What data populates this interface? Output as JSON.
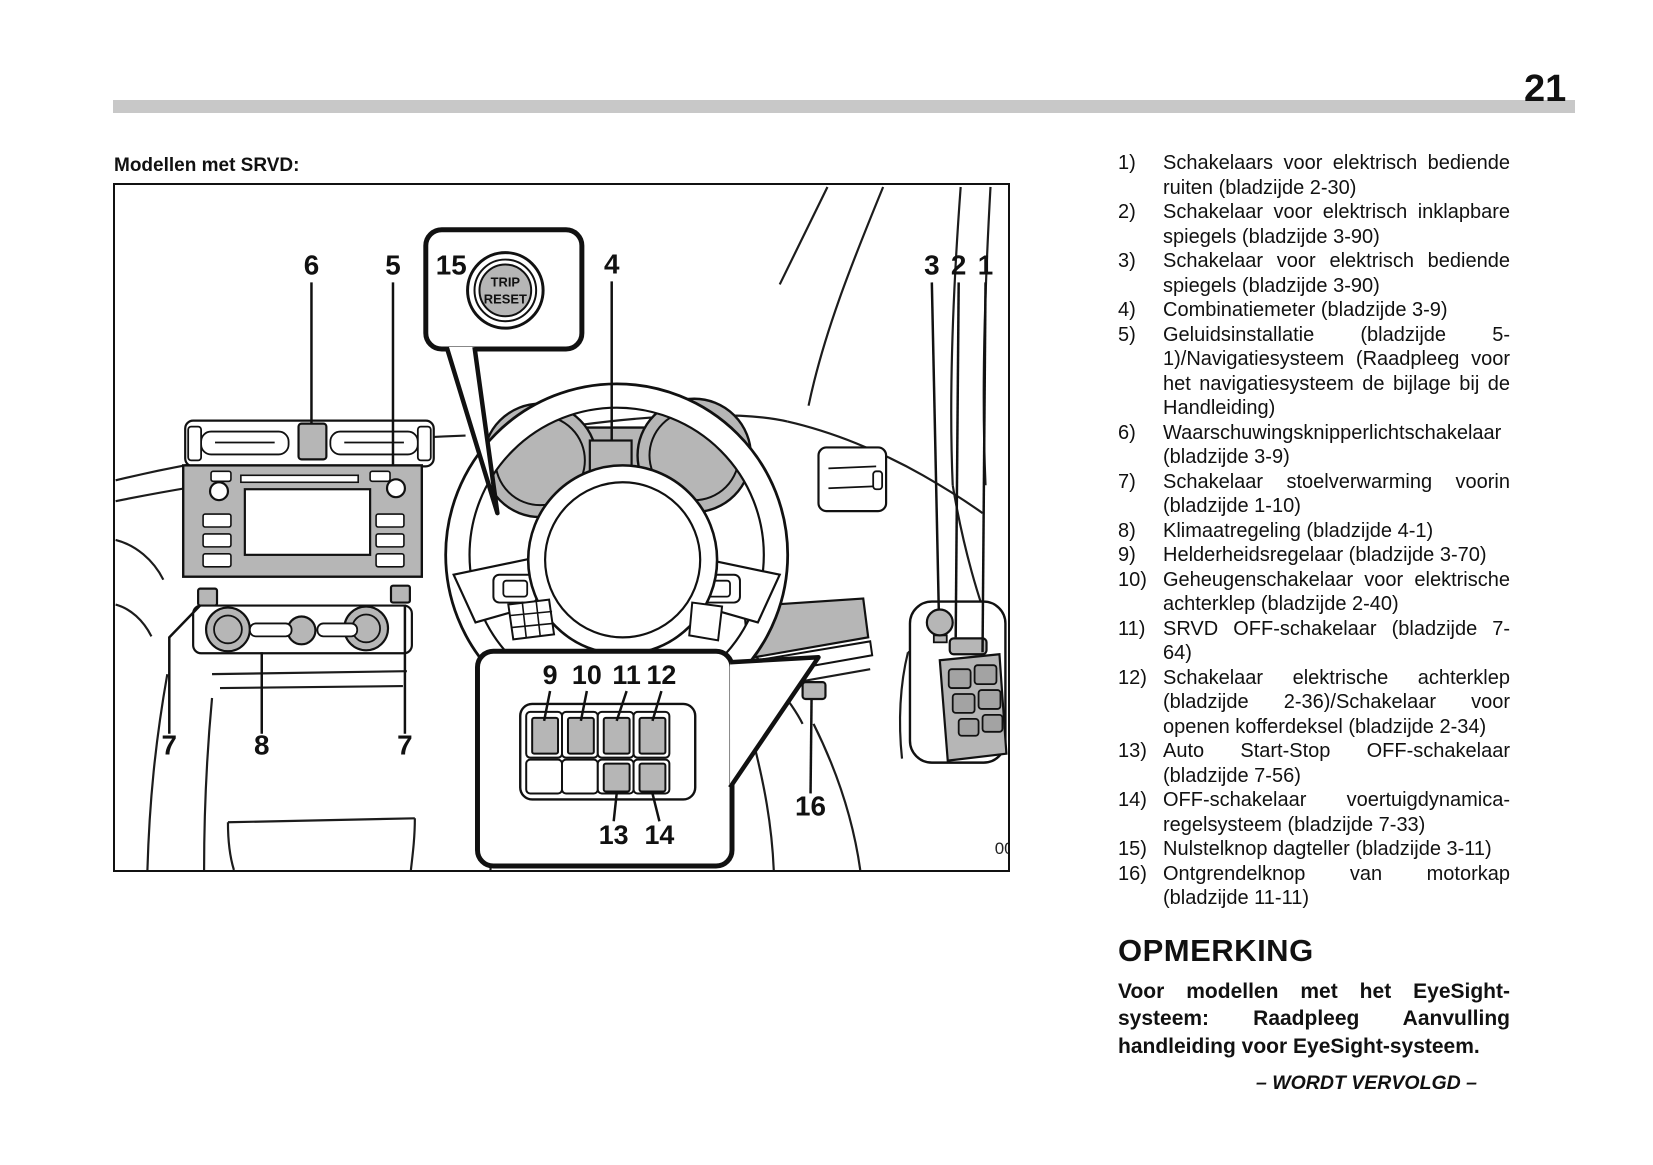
{
  "page": {
    "number": "21",
    "continued_footer": "– WORDT VERVOLGD –"
  },
  "figure": {
    "heading": "Modellen met SRVD:",
    "code": "001502",
    "trip_button": {
      "line1": "TRIP",
      "line2": "RESET"
    },
    "callouts": {
      "one": "1",
      "two": "2",
      "three": "3",
      "four": "4",
      "five": "5",
      "six": "6",
      "seven_left": "7",
      "seven_right": "7",
      "eight": "8",
      "nine": "9",
      "ten": "10",
      "eleven": "11",
      "twelve": "12",
      "thirteen": "13",
      "fourteen": "14",
      "fifteen": "15",
      "sixteen": "16"
    }
  },
  "legend": {
    "items": [
      {
        "num": "1)",
        "text": "Schakelaars voor elektrisch bediende ruiten (bladzijde 2-30)"
      },
      {
        "num": "2)",
        "text": "Schakelaar voor elektrisch inklapbare spiegels (bladzijde 3-90)"
      },
      {
        "num": "3)",
        "text": "Schakelaar voor elektrisch bediende spiegels (bladzijde 3-90)"
      },
      {
        "num": "4)",
        "text": "Combinatiemeter (bladzijde 3-9)"
      },
      {
        "num": "5)",
        "text": "Geluidsinstallatie (bladzijde 5-1)/Navigatiesysteem (Raadpleeg voor het navigatiesysteem de bijlage bij de Handleiding)"
      },
      {
        "num": "6)",
        "text": "Waarschuwingsknipperlichtschakelaar (bladzijde 3-9)"
      },
      {
        "num": "7)",
        "text": "Schakelaar stoelverwarming voorin (bladzijde 1-10)"
      },
      {
        "num": "8)",
        "text": "Klimaatregeling (bladzijde 4-1)"
      },
      {
        "num": "9)",
        "text": "Helderheidsregelaar (bladzijde 3-70)"
      },
      {
        "num": "10)",
        "text": "Geheugenschakelaar voor elektrische achterklep (bladzijde 2-40)"
      },
      {
        "num": "11)",
        "text": "SRVD OFF-schakelaar (bladzijde 7-64)"
      },
      {
        "num": "12)",
        "text": "Schakelaar elektrische achterklep (bladzijde 2-36)/Schakelaar voor openen kofferdeksel (bladzijde 2-34)"
      },
      {
        "num": "13)",
        "text": "Auto Start-Stop OFF-schakelaar (bladzijde 7-56)"
      },
      {
        "num": "14)",
        "text": "OFF-schakelaar voertuigdynamica-regelsysteem (bladzijde 7-33)"
      },
      {
        "num": "15)",
        "text": "Nulstelknop dagteller (bladzijde 3-11)"
      },
      {
        "num": "16)",
        "text": "Ontgrendelknop van motorkap (bladzijde 11-11)"
      }
    ]
  },
  "note": {
    "heading": "OPMERKING",
    "body": "Voor modellen met het EyeSight-systeem: Raadpleeg Aanvulling handleiding voor EyeSight-systeem."
  }
}
